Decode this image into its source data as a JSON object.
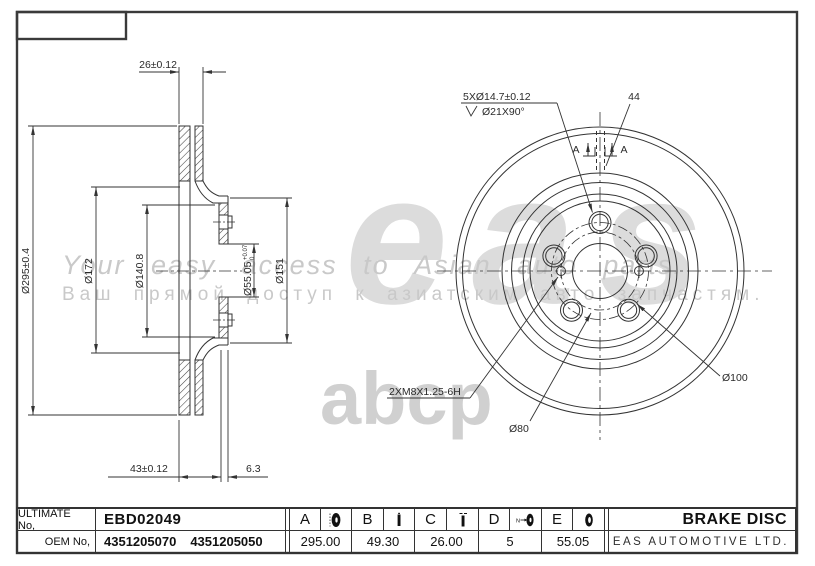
{
  "watermarks": {
    "logo_primary": "eas",
    "logo_secondary": "abcp",
    "tagline_en": "Your easy access to Asian auto parts.",
    "tagline_ru": "Ваш прямой доступ к азиатским авто запчастям."
  },
  "section_view": {
    "thickness": "26±0.12",
    "outer_diameter": "Ø295±0.4",
    "dia_172": "Ø172",
    "dia_140_8": "Ø140.8",
    "bore": "Ø55.05",
    "bore_tol_upper": "+0.07",
    "bore_tol_lower": "0",
    "dia_151": "Ø151",
    "height": "43±0.12",
    "flange_thickness": "6.3"
  },
  "front_view": {
    "bolt_holes": "5XØ14.7±0.12",
    "countersink": "Ø21X90°",
    "slot_width": "44",
    "section_mark": "A",
    "thread_holes": "2XM8X1.25-6H",
    "dia_80": "Ø80",
    "dia_100": "Ø100"
  },
  "title_block": {
    "row1_label": "ULTIMATE No,",
    "row2_label": "OEM No,",
    "ultimate_no": "EBD02049",
    "oem_no_1": "4351205070",
    "oem_no_2": "4351205050",
    "product_title": "BRAKE DISC",
    "company": "EAS AUTOMOTIVE LTD.",
    "dims": [
      {
        "letter": "A",
        "value": "295.00"
      },
      {
        "letter": "B",
        "value": "49.30"
      },
      {
        "letter": "C",
        "value": "26.00"
      },
      {
        "letter": "D",
        "value": "5"
      },
      {
        "letter": "E",
        "value": "55.05"
      }
    ]
  }
}
